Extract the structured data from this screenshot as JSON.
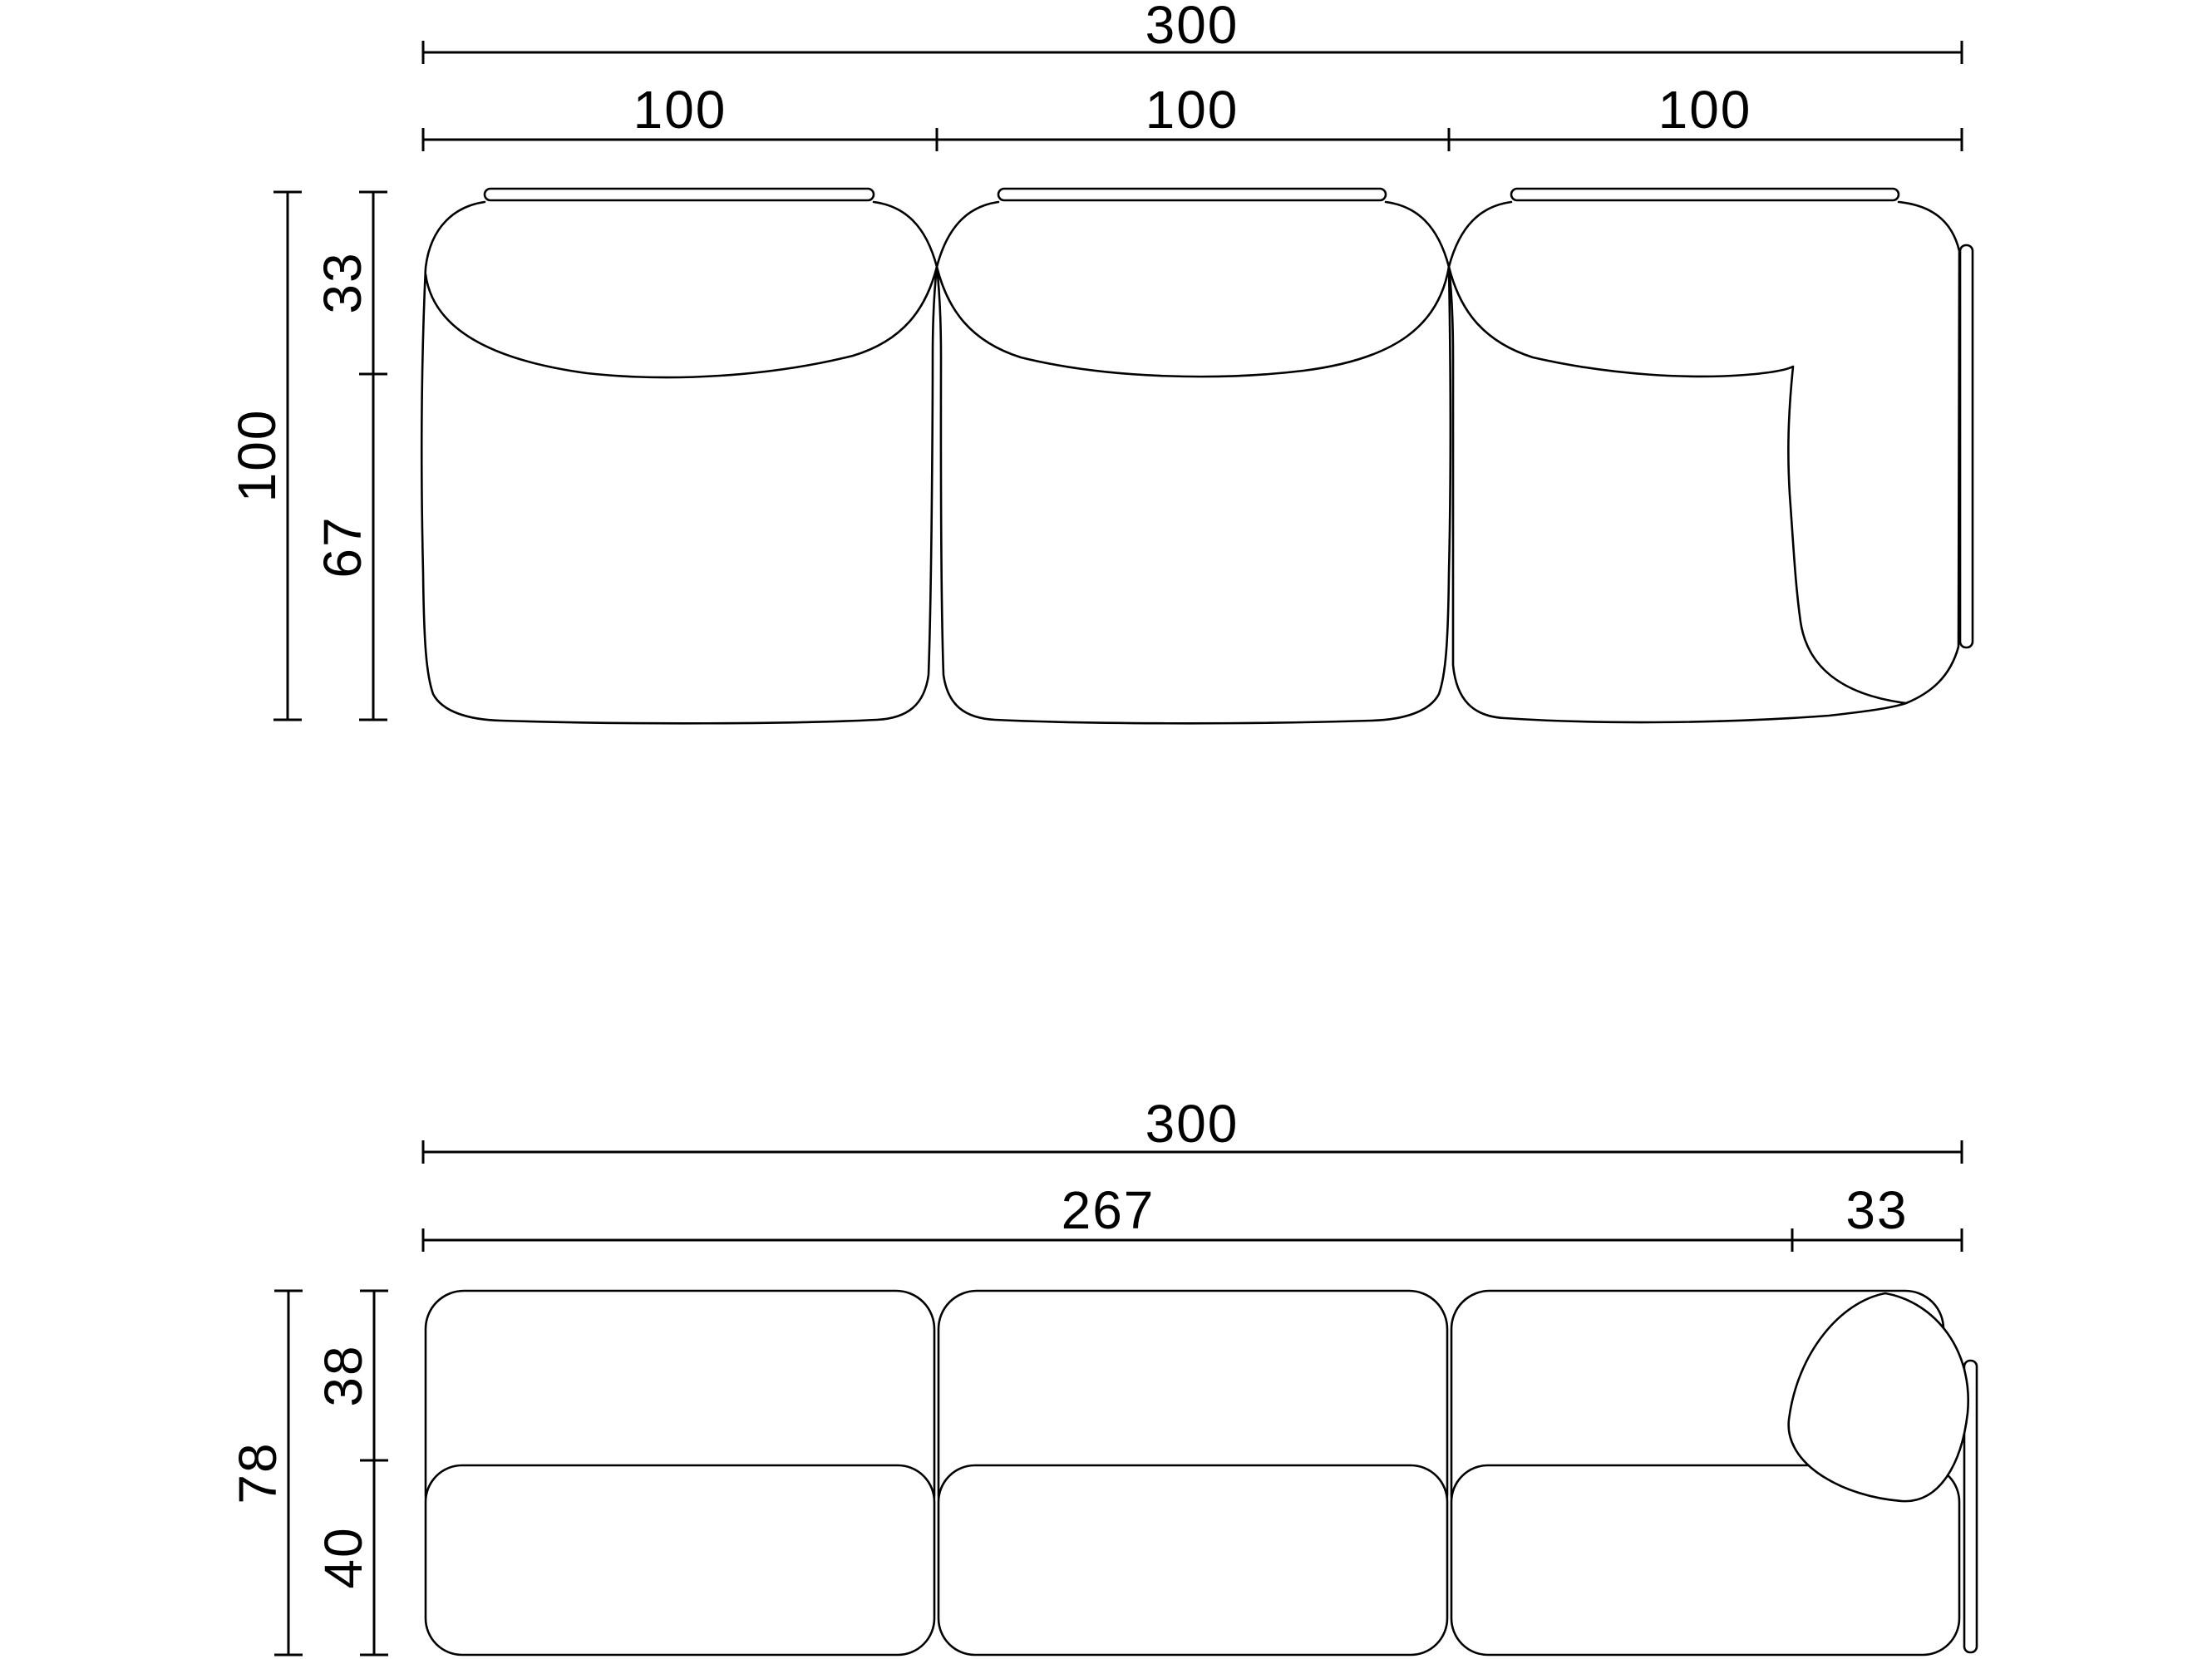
{
  "drawing": {
    "description": "Modular sofa technical dimension drawing, plan view and front elevation",
    "colors": {
      "line": "#000000",
      "background": "#ffffff"
    },
    "top_view": {
      "overall_width": "300",
      "module_widths": [
        "100",
        "100",
        "100"
      ],
      "overall_depth": "100",
      "depth_segments": [
        "33",
        "67"
      ]
    },
    "front_view": {
      "overall_width": "300",
      "width_segments": [
        "267",
        "33"
      ],
      "overall_height": "78",
      "height_segments": [
        "38",
        "40"
      ]
    }
  }
}
